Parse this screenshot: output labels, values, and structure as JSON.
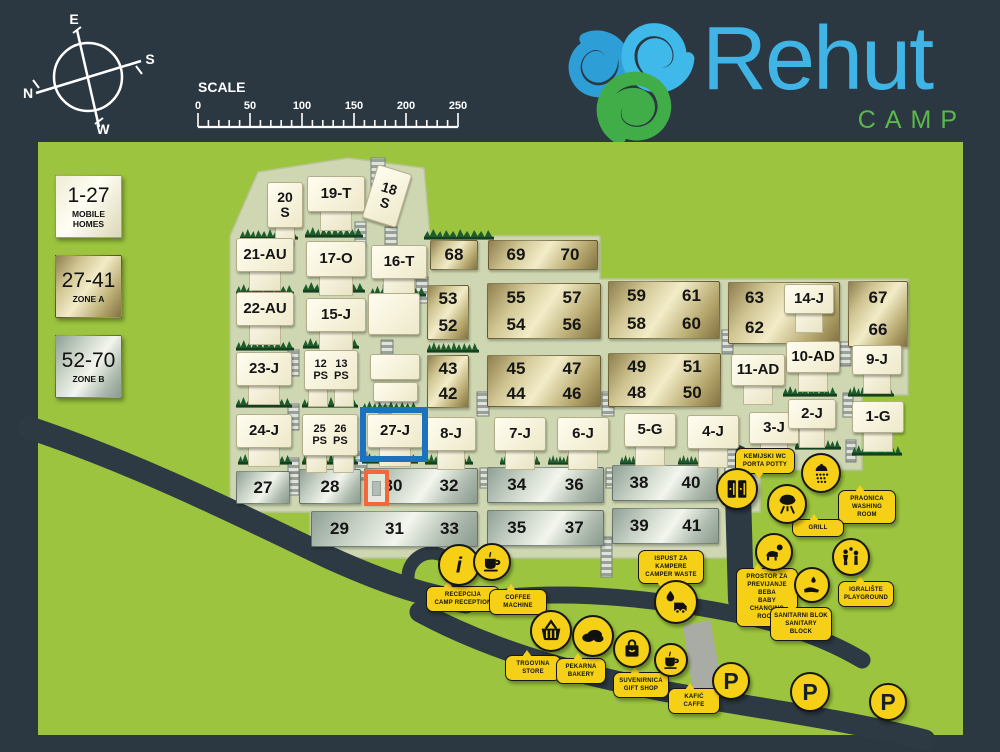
{
  "header": {
    "compass": {
      "top": "E",
      "right": "S",
      "left": "N",
      "bottom": "W"
    },
    "scale": {
      "label": "SCALE",
      "ticks": [
        "0",
        "50",
        "100",
        "150",
        "200",
        "250"
      ]
    },
    "logo": {
      "title": "Rehut",
      "subtitle": "CAMP"
    }
  },
  "legend": [
    {
      "range": "1-27",
      "label": "MOBILE HOMES",
      "style": "cream"
    },
    {
      "range": "27-41",
      "label": "ZONE A",
      "style": "gold"
    },
    {
      "range": "52-70",
      "label": "ZONE B",
      "style": "silver"
    }
  ],
  "map": {
    "selected_plot": "27-J",
    "homes": [
      {
        "id": "20-S",
        "label": "20\nS",
        "x": 267,
        "y": 182,
        "w": 36,
        "h": 46
      },
      {
        "id": "19-T",
        "label": "19-T",
        "x": 307,
        "y": 176,
        "w": 58,
        "h": 36
      },
      {
        "id": "18-S",
        "label": "18\nS",
        "x": 369,
        "y": 168,
        "w": 36,
        "h": 56,
        "rot": 17,
        "stub": "none"
      },
      {
        "id": "21-AU",
        "label": "21-AU",
        "x": 236,
        "y": 238,
        "w": 58,
        "h": 34
      },
      {
        "id": "17-O",
        "label": "17-O",
        "x": 306,
        "y": 241,
        "w": 60,
        "h": 36
      },
      {
        "id": "16-T",
        "label": "16-T",
        "x": 371,
        "y": 245,
        "w": 56,
        "h": 34
      },
      {
        "id": "22-AU",
        "label": "22-AU",
        "x": 236,
        "y": 292,
        "w": 58,
        "h": 34
      },
      {
        "id": "15-J",
        "label": "15-J",
        "x": 306,
        "y": 298,
        "w": 60,
        "h": 34
      },
      {
        "id": "23-J",
        "label": "23-J",
        "x": 236,
        "y": 352,
        "w": 56,
        "h": 34
      },
      {
        "id": "12-13-PS",
        "two": [
          "12\nPS",
          "13\nPS"
        ],
        "x": 304,
        "y": 350,
        "w": 54,
        "h": 40
      },
      {
        "id": "24-J",
        "label": "24-J",
        "x": 236,
        "y": 414,
        "w": 56,
        "h": 34
      },
      {
        "id": "25-26-PS",
        "two": [
          "25\nPS",
          "26\nPS"
        ],
        "x": 302,
        "y": 414,
        "w": 56,
        "h": 42
      },
      {
        "id": "27-J",
        "label": "27-J",
        "x": 367,
        "y": 414,
        "w": 56,
        "h": 34
      },
      {
        "id": "8-J",
        "label": "8-J",
        "x": 426,
        "y": 417,
        "w": 50,
        "h": 34
      },
      {
        "id": "7-J",
        "label": "7-J",
        "x": 494,
        "y": 417,
        "w": 52,
        "h": 34
      },
      {
        "id": "6-J",
        "label": "6-J",
        "x": 557,
        "y": 417,
        "w": 52,
        "h": 34
      },
      {
        "id": "5-G",
        "label": "5-G",
        "x": 624,
        "y": 413,
        "w": 52,
        "h": 34
      },
      {
        "id": "4-J",
        "label": "4-J",
        "x": 687,
        "y": 415,
        "w": 52,
        "h": 34
      },
      {
        "id": "3-J",
        "label": "3-J",
        "x": 749,
        "y": 412,
        "w": 50,
        "h": 32
      },
      {
        "id": "2-J",
        "label": "2-J",
        "x": 788,
        "y": 399,
        "w": 48,
        "h": 30
      },
      {
        "id": "1-G",
        "label": "1-G",
        "x": 852,
        "y": 401,
        "w": 52,
        "h": 32
      },
      {
        "id": "9-J",
        "label": "9-J",
        "x": 852,
        "y": 345,
        "w": 50,
        "h": 30
      },
      {
        "id": "10-AD",
        "label": "10-AD",
        "x": 786,
        "y": 341,
        "w": 54,
        "h": 32
      },
      {
        "id": "11-AD",
        "label": "11-AD",
        "x": 731,
        "y": 354,
        "w": 54,
        "h": 32
      },
      {
        "id": "14-J",
        "label": "14-J",
        "x": 784,
        "y": 284,
        "w": 50,
        "h": 30
      },
      {
        "id": "outbuilding-1",
        "label": "",
        "x": 368,
        "y": 293,
        "w": 52,
        "h": 42,
        "stub": "none"
      },
      {
        "id": "outbuilding-2",
        "label": "",
        "x": 370,
        "y": 354,
        "w": 50,
        "h": 26,
        "stub": "none"
      },
      {
        "id": "outbuilding-3",
        "label": "",
        "x": 373,
        "y": 382,
        "w": 45,
        "h": 20,
        "stub": "none"
      }
    ],
    "gold_blocks": [
      {
        "x": 430,
        "y": 240,
        "w": 48,
        "h": 30,
        "rows": [
          [
            "68"
          ]
        ]
      },
      {
        "x": 488,
        "y": 240,
        "w": 110,
        "h": 30,
        "rows": [
          [
            "69",
            "70"
          ]
        ]
      },
      {
        "x": 427,
        "y": 285,
        "w": 42,
        "h": 55,
        "rows": [
          [
            "53"
          ],
          [
            "52"
          ]
        ]
      },
      {
        "x": 487,
        "y": 283,
        "w": 114,
        "h": 56,
        "rows": [
          [
            "55",
            "57"
          ],
          [
            "54",
            "56"
          ]
        ]
      },
      {
        "x": 608,
        "y": 281,
        "w": 112,
        "h": 58,
        "rows": [
          [
            "59",
            "61"
          ],
          [
            "58",
            "60"
          ]
        ]
      },
      {
        "x": 427,
        "y": 355,
        "w": 42,
        "h": 53,
        "rows": [
          [
            "43"
          ],
          [
            "42"
          ]
        ]
      },
      {
        "x": 487,
        "y": 355,
        "w": 114,
        "h": 52,
        "rows": [
          [
            "45",
            "47"
          ],
          [
            "44",
            "46"
          ]
        ]
      },
      {
        "x": 608,
        "y": 353,
        "w": 113,
        "h": 54,
        "rows": [
          [
            "49",
            "51"
          ],
          [
            "48",
            "50"
          ]
        ]
      },
      {
        "x": 728,
        "y": 282,
        "w": 112,
        "h": 62,
        "rows": [
          [
            "63"
          ],
          [
            "62"
          ]
        ],
        "align": "left"
      },
      {
        "x": 848,
        "y": 281,
        "w": 60,
        "h": 66,
        "rows": [
          [
            "67"
          ],
          [
            "66"
          ]
        ]
      }
    ],
    "silver_blocks": [
      {
        "x": 236,
        "y": 471,
        "w": 54,
        "h": 33,
        "rows": [
          [
            "27"
          ]
        ]
      },
      {
        "x": 299,
        "y": 469,
        "w": 62,
        "h": 35,
        "rows": [
          [
            "28"
          ]
        ]
      },
      {
        "x": 364,
        "y": 468,
        "w": 114,
        "h": 36,
        "rows": [
          [
            "30",
            "32"
          ]
        ]
      },
      {
        "x": 487,
        "y": 467,
        "w": 117,
        "h": 36,
        "rows": [
          [
            "34",
            "36"
          ]
        ]
      },
      {
        "x": 612,
        "y": 465,
        "w": 106,
        "h": 36,
        "rows": [
          [
            "38",
            "40"
          ]
        ]
      },
      {
        "x": 311,
        "y": 511,
        "w": 167,
        "h": 36,
        "rows": [
          [
            "29",
            "31",
            "33"
          ]
        ]
      },
      {
        "x": 487,
        "y": 510,
        "w": 117,
        "h": 36,
        "rows": [
          [
            "35",
            "37"
          ]
        ]
      },
      {
        "x": 612,
        "y": 508,
        "w": 107,
        "h": 36,
        "rows": [
          [
            "39",
            "41"
          ]
        ]
      }
    ]
  },
  "facilities": [
    {
      "name": "camp-reception",
      "icon": "info",
      "circle": {
        "x": 459,
        "y": 565,
        "r": 21
      },
      "label": {
        "x": 426,
        "y": 586,
        "w": 74,
        "tail": "up"
      },
      "lines": [
        "RECEPCIJA",
        "CAMP RECEPTION"
      ]
    },
    {
      "name": "coffee-machine",
      "icon": "coffee",
      "circle": {
        "x": 492,
        "y": 562,
        "r": 19
      },
      "label": {
        "x": 489,
        "y": 589,
        "w": 58,
        "tail": "up"
      },
      "lines": [
        "COFFEE",
        "MACHINE"
      ]
    },
    {
      "name": "camper-waste",
      "icon": "camper",
      "circle": {
        "x": 676,
        "y": 602,
        "r": 22
      },
      "label": {
        "x": 638,
        "y": 550,
        "w": 66,
        "tail": "down"
      },
      "lines": [
        "ISPUST ZA",
        "KAMPERE",
        "CAMPER WASTE"
      ]
    },
    {
      "name": "porta-potty",
      "icon": "toilets",
      "circle": {
        "x": 737,
        "y": 489,
        "r": 21
      },
      "label": {
        "x": 735,
        "y": 448,
        "w": 60,
        "tail": "down"
      },
      "lines": [
        "KEMIJSKI WC",
        "PORTA POTTY"
      ]
    },
    {
      "name": "washing-room",
      "icon": "shower",
      "circle": {
        "x": 821,
        "y": 473,
        "r": 20
      },
      "label": {
        "x": 838,
        "y": 490,
        "w": 58,
        "tail": "up"
      },
      "lines": [
        "PRAONICA",
        "WASHING ROOM"
      ]
    },
    {
      "name": "grill",
      "icon": "grill",
      "circle": {
        "x": 787,
        "y": 504,
        "r": 20
      },
      "label": {
        "x": 792,
        "y": 519,
        "w": 52,
        "tail": "up"
      },
      "lines": [
        "GRILL"
      ]
    },
    {
      "name": "baby-changing-room",
      "icon": "baby",
      "circle": {
        "x": 774,
        "y": 552,
        "r": 19
      },
      "label": {
        "x": 736,
        "y": 568,
        "w": 62,
        "tail": "up"
      },
      "lines": [
        "PROSTOR ZA",
        "PREVIJANJE BEBA",
        "BABY",
        "CHANGING ROOM"
      ]
    },
    {
      "name": "playground",
      "icon": "kids",
      "circle": {
        "x": 851,
        "y": 557,
        "r": 19
      },
      "label": {
        "x": 838,
        "y": 581,
        "w": 56,
        "tail": "up"
      },
      "lines": [
        "IGRALIŠTE",
        "PLAYGROUND"
      ]
    },
    {
      "name": "sanitary-block",
      "icon": "wash",
      "circle": {
        "x": 812,
        "y": 585,
        "r": 18
      },
      "label": {
        "x": 770,
        "y": 607,
        "w": 62,
        "tail": "up"
      },
      "lines": [
        "SANITARNI BLOK",
        "SANITARY BLOCK"
      ]
    },
    {
      "name": "store",
      "icon": "basket",
      "circle": {
        "x": 551,
        "y": 631,
        "r": 21
      },
      "label": {
        "x": 505,
        "y": 655,
        "w": 56,
        "tail": "up"
      },
      "lines": [
        "TRGOVINA",
        "STORE"
      ]
    },
    {
      "name": "bakery",
      "icon": "bread",
      "circle": {
        "x": 593,
        "y": 636,
        "r": 21
      },
      "label": {
        "x": 556,
        "y": 658,
        "w": 50,
        "tail": "up"
      },
      "lines": [
        "PEKARNA",
        "BAKERY"
      ]
    },
    {
      "name": "gift-shop",
      "icon": "bag",
      "circle": {
        "x": 632,
        "y": 649,
        "r": 19
      },
      "label": {
        "x": 613,
        "y": 672,
        "w": 56,
        "tail": "up"
      },
      "lines": [
        "SUVENIRNICA",
        "GIFT SHOP"
      ]
    },
    {
      "name": "caffe",
      "icon": "coffee",
      "circle": {
        "x": 671,
        "y": 660,
        "r": 17
      },
      "label": {
        "x": 668,
        "y": 688,
        "w": 52,
        "tail": "up"
      },
      "lines": [
        "KAFIĆ",
        "CAFFE"
      ]
    }
  ],
  "parking": [
    {
      "label": "P",
      "x": 731,
      "y": 681,
      "r": 19
    },
    {
      "label": "P",
      "x": 810,
      "y": 692,
      "r": 20
    },
    {
      "label": "P",
      "x": 888,
      "y": 702,
      "r": 19
    }
  ],
  "colors": {
    "background_dark": "#2b3841",
    "map_green": "#9cc43e",
    "plot_area_pale": "#ced7b2",
    "zone_a_gold": "#cfc491",
    "zone_b_silver": "#c6d0c4",
    "mobile_home_cream": "#fffdf0",
    "marker_yellow": "#f5d017",
    "highlight_blue": "#1d72c0",
    "highlight_orange": "#f2683c",
    "road_dark": "#2d3a43",
    "hedge_green": "#1d5c2b",
    "logo_blue": "#41b4e6",
    "logo_green": "#5bb94b"
  }
}
